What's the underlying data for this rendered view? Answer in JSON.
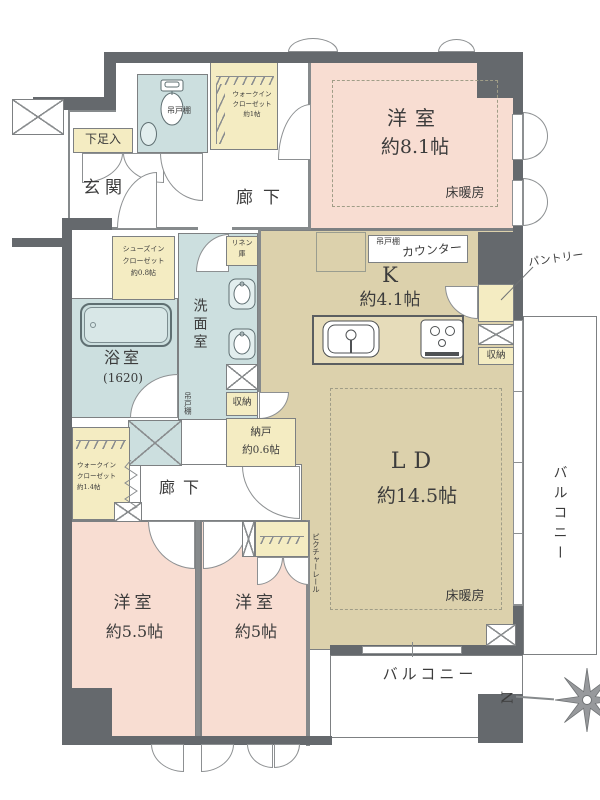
{
  "rooms": {
    "bedroom_main": {
      "name": "洋室",
      "size": "約8.1帖",
      "floor_heating": "床暖房"
    },
    "bedroom_2": {
      "name": "洋室",
      "size": "約5.5帖"
    },
    "bedroom_3": {
      "name": "洋室",
      "size": "約5帖"
    },
    "living_dining": {
      "name": "LD",
      "size": "約14.5帖",
      "floor_heating": "床暖房",
      "picture_rail": "ピクチャーレール"
    },
    "kitchen": {
      "name": "K",
      "size": "約4.1帖",
      "counter": "カウンター",
      "cupboard": "吊戸棚",
      "pantry": "パントリー",
      "pantry_storage": "収納"
    },
    "entrance": {
      "name": "玄関",
      "shoe_box": "下足入"
    },
    "corridor_upper": {
      "name": "廊下"
    },
    "corridor_lower": {
      "name": "廊下"
    },
    "toilet": {
      "cupboard": "吊戸棚"
    },
    "bathroom": {
      "name": "浴室",
      "size": "(1620)"
    },
    "washroom": {
      "name": "洗面室",
      "cupboard": "吊戸棚",
      "storage": "収納",
      "linen_line1": "リネン",
      "linen_line2": "庫"
    },
    "wic_upper": {
      "line1": "ウォークイン",
      "line2": "クローゼット",
      "line3": "約1帖"
    },
    "wic_lower": {
      "line1": "ウォークイン",
      "line2": "クローゼット",
      "line3": "約1.4帖"
    },
    "sic": {
      "line1": "シューズイン",
      "line2": "クローゼット",
      "line3": "約0.8帖"
    },
    "nando": {
      "name": "納戸",
      "size": "約0.6帖"
    },
    "balcony_right": {
      "name": "バルコニー"
    },
    "balcony_bottom": {
      "name": "バルコニー"
    }
  },
  "compass": {
    "north": "N"
  },
  "colors": {
    "wall": "#65696d",
    "bedroom": "#f8ddd2",
    "living": "#dcd1ac",
    "wet_area": "#ccdfdf",
    "storage": "#f4ecc2"
  }
}
